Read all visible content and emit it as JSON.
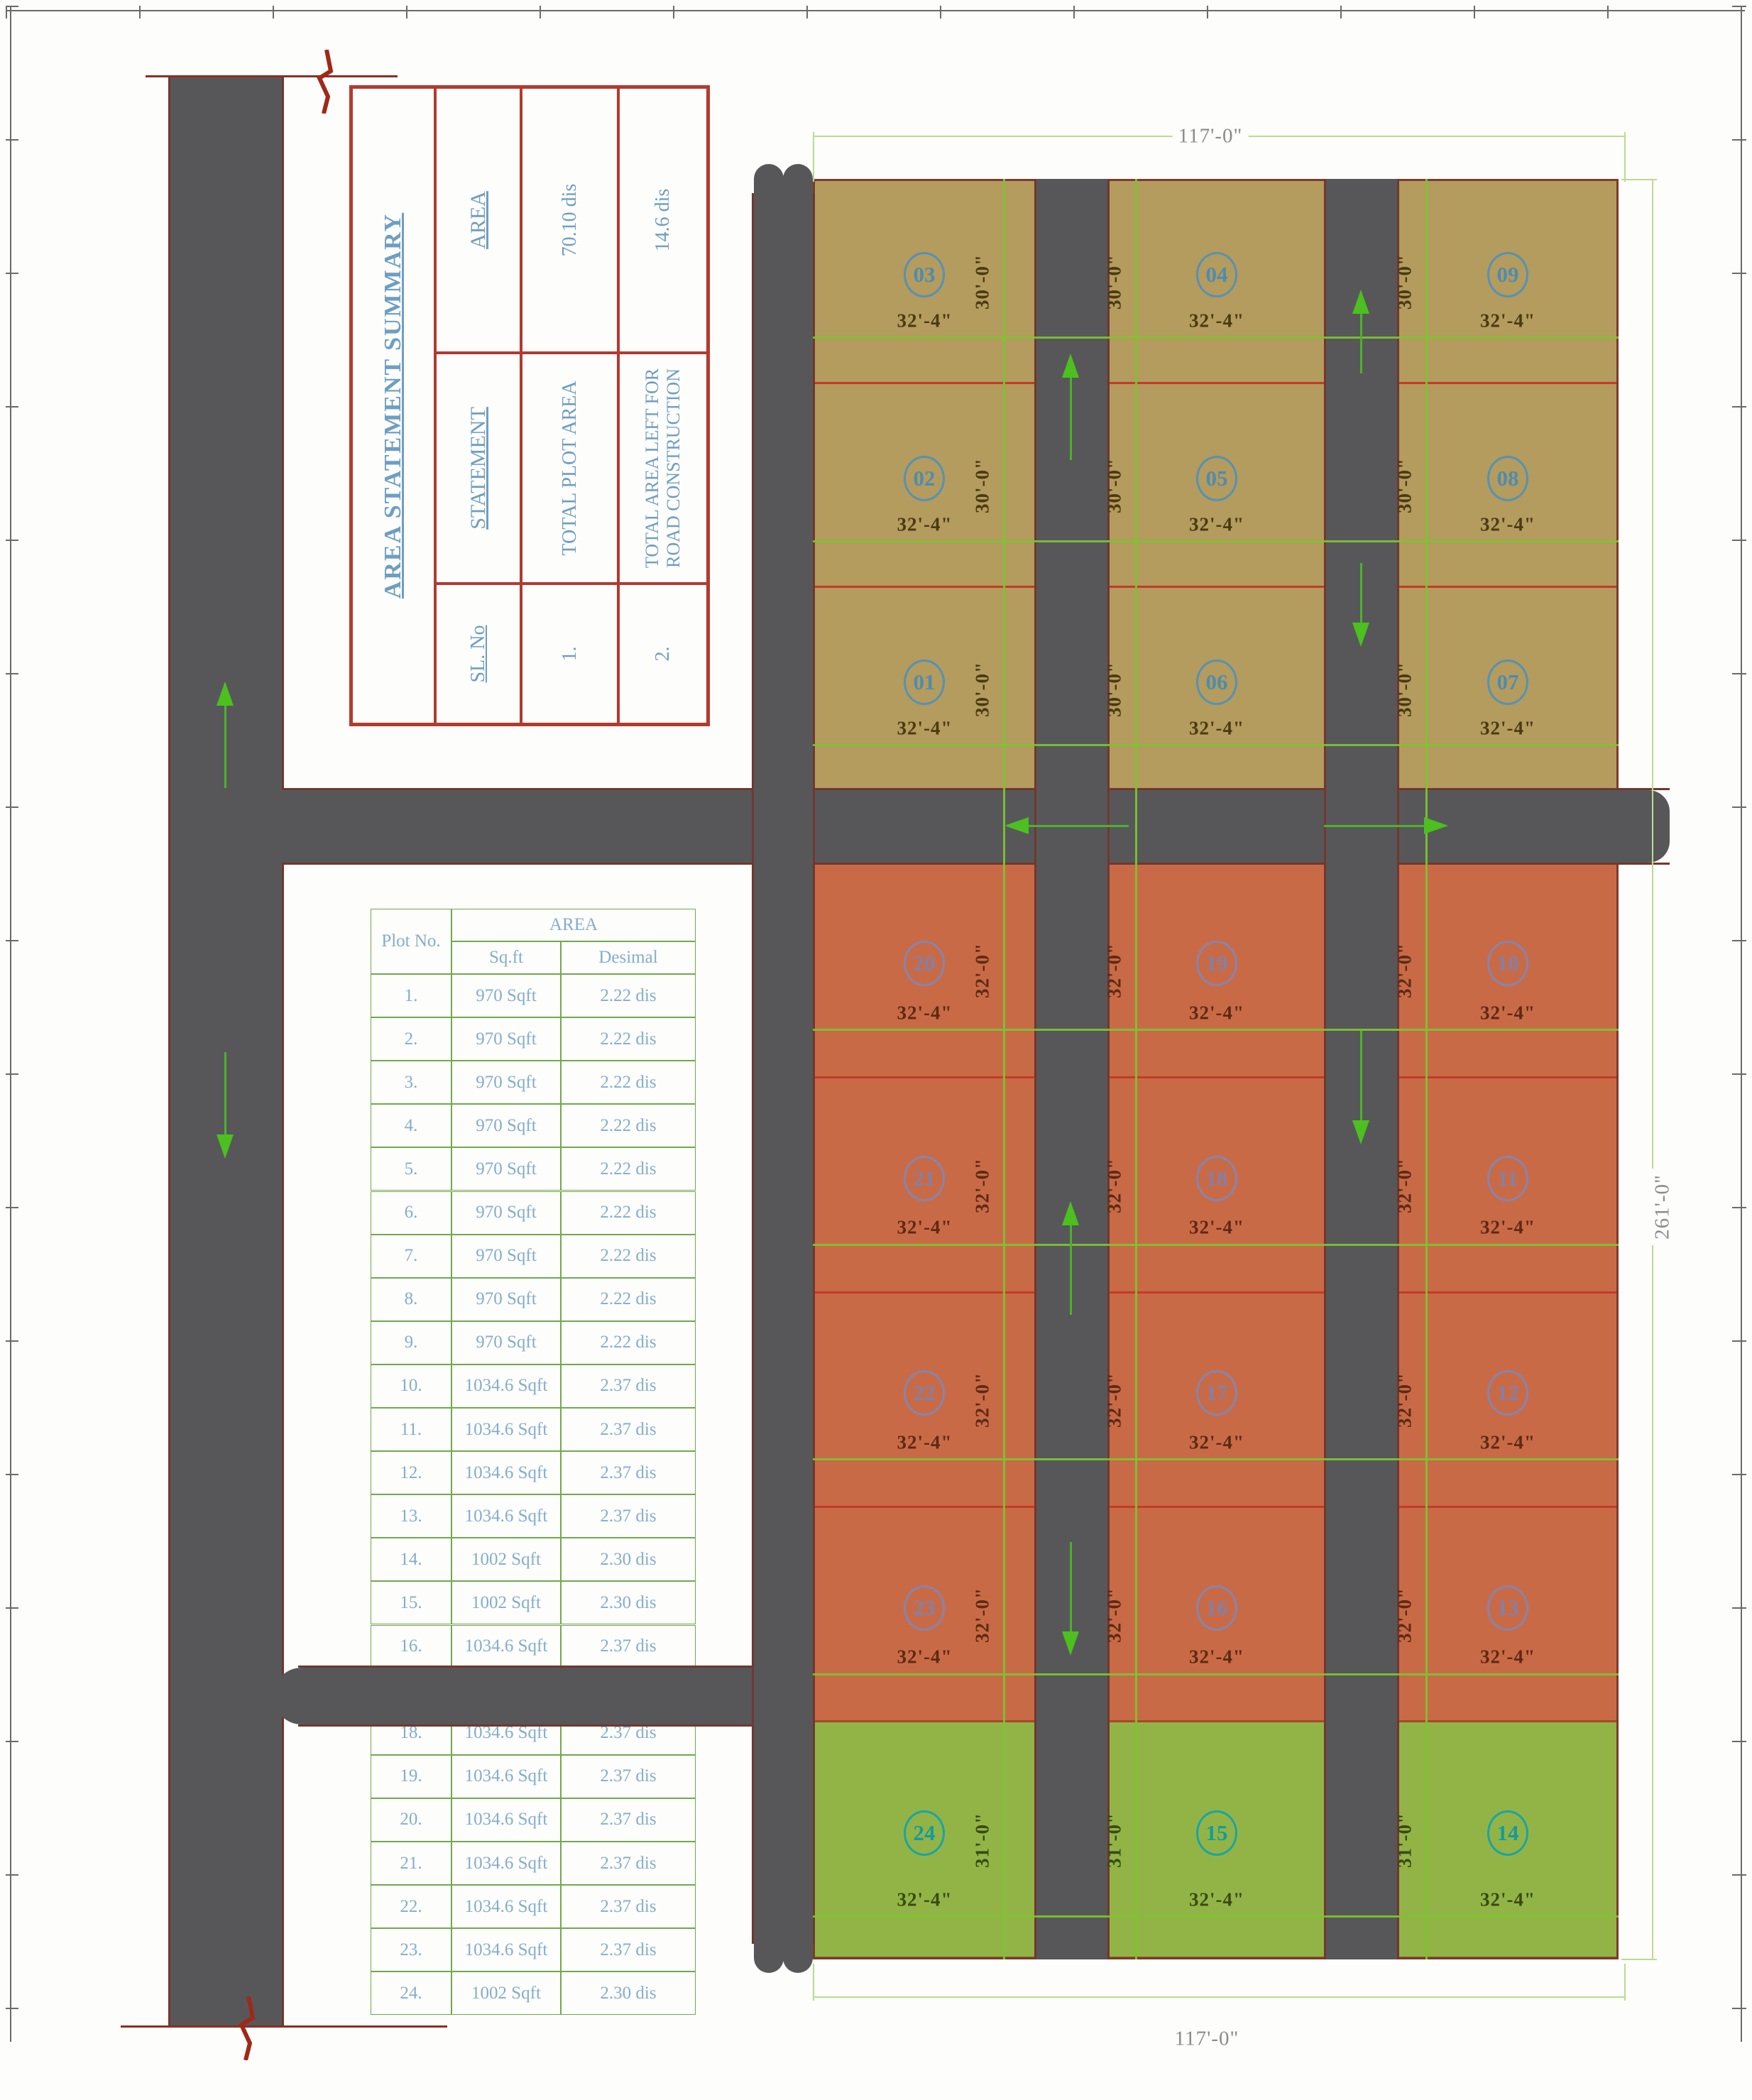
{
  "summary_table": {
    "title": "AREA STATEMENT SUMMARY",
    "headers": {
      "sl": "SL. No",
      "statement": "STATEMENT",
      "area": "AREA"
    },
    "rows": [
      {
        "sl": "1.",
        "statement": "TOTAL PLOT AREA",
        "area": "70.10 dis"
      },
      {
        "sl": "2.",
        "statement": "TOTAL AREA LEFT FOR ROAD CONSTRUCTION",
        "area": "14.6 dis"
      }
    ]
  },
  "plot_table": {
    "col_plot": "Plot No.",
    "col_area": "AREA",
    "col_sqft": "Sq.ft",
    "col_desimal": "Desimal",
    "rows": [
      {
        "no": "1.",
        "sqft": "970 Sqft",
        "des": "2.22 dis"
      },
      {
        "no": "2.",
        "sqft": "970 Sqft",
        "des": "2.22 dis"
      },
      {
        "no": "3.",
        "sqft": "970 Sqft",
        "des": "2.22 dis"
      },
      {
        "no": "4.",
        "sqft": "970 Sqft",
        "des": "2.22 dis"
      },
      {
        "no": "5.",
        "sqft": "970 Sqft",
        "des": "2.22 dis"
      },
      {
        "no": "6.",
        "sqft": "970 Sqft",
        "des": "2.22 dis"
      },
      {
        "no": "7.",
        "sqft": "970 Sqft",
        "des": "2.22 dis"
      },
      {
        "no": "8.",
        "sqft": "970 Sqft",
        "des": "2.22 dis"
      },
      {
        "no": "9.",
        "sqft": "970 Sqft",
        "des": "2.22 dis"
      },
      {
        "no": "10.",
        "sqft": "1034.6 Sqft",
        "des": "2.37 dis"
      },
      {
        "no": "11.",
        "sqft": "1034.6 Sqft",
        "des": "2.37 dis"
      },
      {
        "no": "12.",
        "sqft": "1034.6 Sqft",
        "des": "2.37 dis"
      },
      {
        "no": "13.",
        "sqft": "1034.6 Sqft",
        "des": "2.37 dis"
      },
      {
        "no": "14.",
        "sqft": "1002 Sqft",
        "des": "2.30 dis"
      },
      {
        "no": "15.",
        "sqft": "1002 Sqft",
        "des": "2.30 dis"
      },
      {
        "no": "16.",
        "sqft": "1034.6 Sqft",
        "des": "2.37 dis"
      },
      {
        "no": "",
        "sqft": "",
        "des": "",
        "covered_by_road": true
      },
      {
        "no": "18.",
        "sqft": "1034.6 Sqft",
        "des": "2.37 dis"
      },
      {
        "no": "19.",
        "sqft": "1034.6 Sqft",
        "des": "2.37 dis"
      },
      {
        "no": "20.",
        "sqft": "1034.6 Sqft",
        "des": "2.37 dis"
      },
      {
        "no": "21.",
        "sqft": "1034.6 Sqft",
        "des": "2.37 dis"
      },
      {
        "no": "22.",
        "sqft": "1034.6 Sqft",
        "des": "2.37 dis"
      },
      {
        "no": "23.",
        "sqft": "1034.6 Sqft",
        "des": "2.37 dis"
      },
      {
        "no": "24.",
        "sqft": "1002 Sqft",
        "des": "2.30 dis"
      }
    ]
  },
  "site": {
    "dim_top": "117'-0\"",
    "dim_bottom": "117'-0\"",
    "dim_right": "261'-0\"",
    "plot_width_label": "32'-4\"",
    "sections": [
      {
        "name": "olive",
        "height_label": "30'-0\"",
        "rows": [
          [
            "03",
            "04",
            "09"
          ],
          [
            "02",
            "05",
            "08"
          ],
          [
            "01",
            "06",
            "07"
          ]
        ]
      },
      {
        "name": "orange",
        "height_label": "32'-0\"",
        "rows": [
          [
            "20",
            "19",
            "10"
          ],
          [
            "21",
            "18",
            "11"
          ],
          [
            "22",
            "17",
            "12"
          ],
          [
            "23",
            "16",
            "13"
          ]
        ]
      },
      {
        "name": "green",
        "height_label": "31'-0\"",
        "rows": [
          [
            "24",
            "15",
            "14"
          ]
        ]
      }
    ],
    "colors": {
      "olive_fill": "#b49b5e",
      "orange_fill": "#c96a47",
      "green_fill": "#92b447",
      "road": "#57575a",
      "road_edge": "#70382e",
      "dim_line": "#7cc430",
      "separator_red": "#c23b28",
      "arrow_green": "#4bc01e",
      "table_border_green": "#6fa94e",
      "table_text_blue": "#84adcd",
      "summary_border_red": "#b23a30",
      "summary_text_blue": "#6e9ec2"
    }
  }
}
